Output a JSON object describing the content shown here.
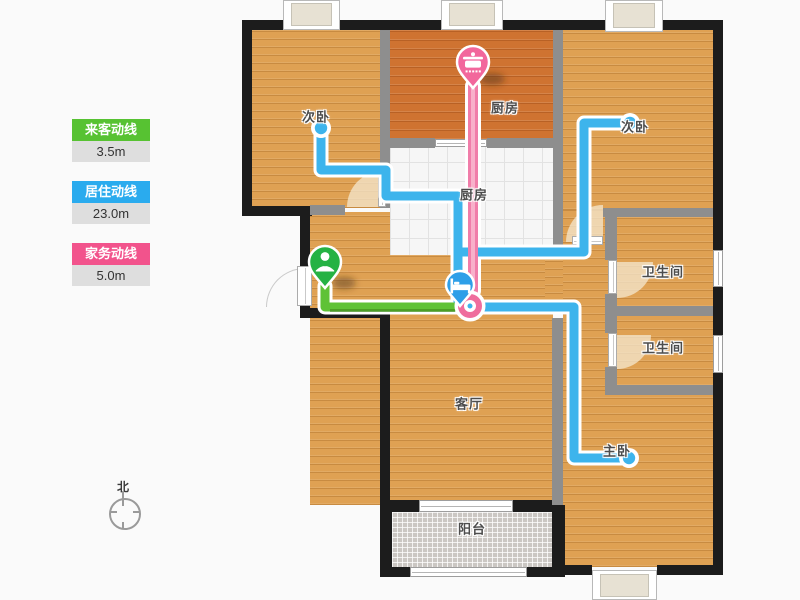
{
  "legend": {
    "items": [
      {
        "id": "visitor",
        "label": "来客动线",
        "value": "3.5m",
        "color": "#57c232"
      },
      {
        "id": "living",
        "label": "居住动线",
        "value": "23.0m",
        "color": "#2aabee"
      },
      {
        "id": "chore",
        "label": "家务动线",
        "value": "5.0m",
        "color": "#f2538c"
      }
    ]
  },
  "routes": {
    "visitor": {
      "name": "来客动线",
      "length": "3.5m",
      "color": "#5fc236"
    },
    "living": {
      "name": "居住动线",
      "length": "23.0m",
      "color": "#3db4ec"
    },
    "chore": {
      "name": "家务动线",
      "length": "5.0m",
      "color": "#f07da9",
      "color_inner": "#f8b0ca",
      "color_ring": "#ef6d9d"
    }
  },
  "rooms": {
    "bedroom_left": "次卧",
    "kitchen": "厨房",
    "bedroom_right": "次卧",
    "kitchen_hall": "厨房",
    "bath1": "卫生间",
    "bath2": "卫生间",
    "living": "客厅",
    "master": "主卧",
    "balcony": "阳台"
  },
  "markers": {
    "entry": {
      "name": "entry-person-marker",
      "color": "#25b244"
    },
    "bed": {
      "name": "bed-marker",
      "color": "#2e9fe8"
    },
    "cooking": {
      "name": "cooking-pot-marker",
      "color": "#f2679c"
    }
  },
  "compass": {
    "north": "北"
  }
}
